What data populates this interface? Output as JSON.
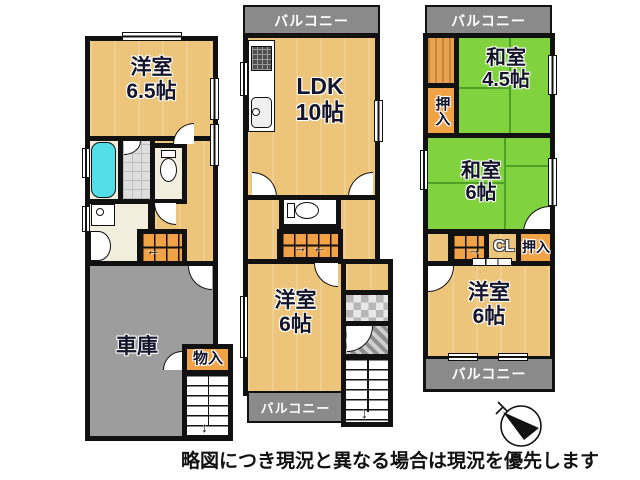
{
  "meta": {
    "disclaimer": "略図につき現況と異なる場合は現況を優先します"
  },
  "colors": {
    "wood_floor": "#ecc57a",
    "tatami_green": "#80d23e",
    "closet_stair_orange": "#f0a246",
    "balcony_gray": "#8a8a8a",
    "garage_gray": "#9d9d9d",
    "bath_cream": "#f1eedd",
    "tub_cyan": "#54dfe8",
    "wall": "#111111"
  },
  "icons": {
    "arrow_left": "←",
    "arrow_right": "→",
    "arrow_down": "↓"
  },
  "f1": {
    "bedroom": {
      "name": "洋室",
      "size": "6.5帖"
    },
    "garage": {
      "name": "車庫"
    },
    "storage": {
      "name": "物入"
    }
  },
  "f2": {
    "balcony_top": "バルコニー",
    "ldk": {
      "name": "LDK",
      "size": "10帖"
    },
    "bedroom": {
      "name": "洋室",
      "size": "6帖"
    },
    "balcony_bottom": "バルコニー"
  },
  "f3": {
    "balcony_top": "バルコニー",
    "jproom45": {
      "name": "和室",
      "size": "4.5帖"
    },
    "oshiire_upper": "押入",
    "jproom6": {
      "name": "和室",
      "size": "6帖"
    },
    "closet_cl": "CL",
    "oshiire_lower": "押入",
    "bedroom": {
      "name": "洋室",
      "size": "6帖"
    },
    "balcony_bottom": "バルコニー"
  }
}
